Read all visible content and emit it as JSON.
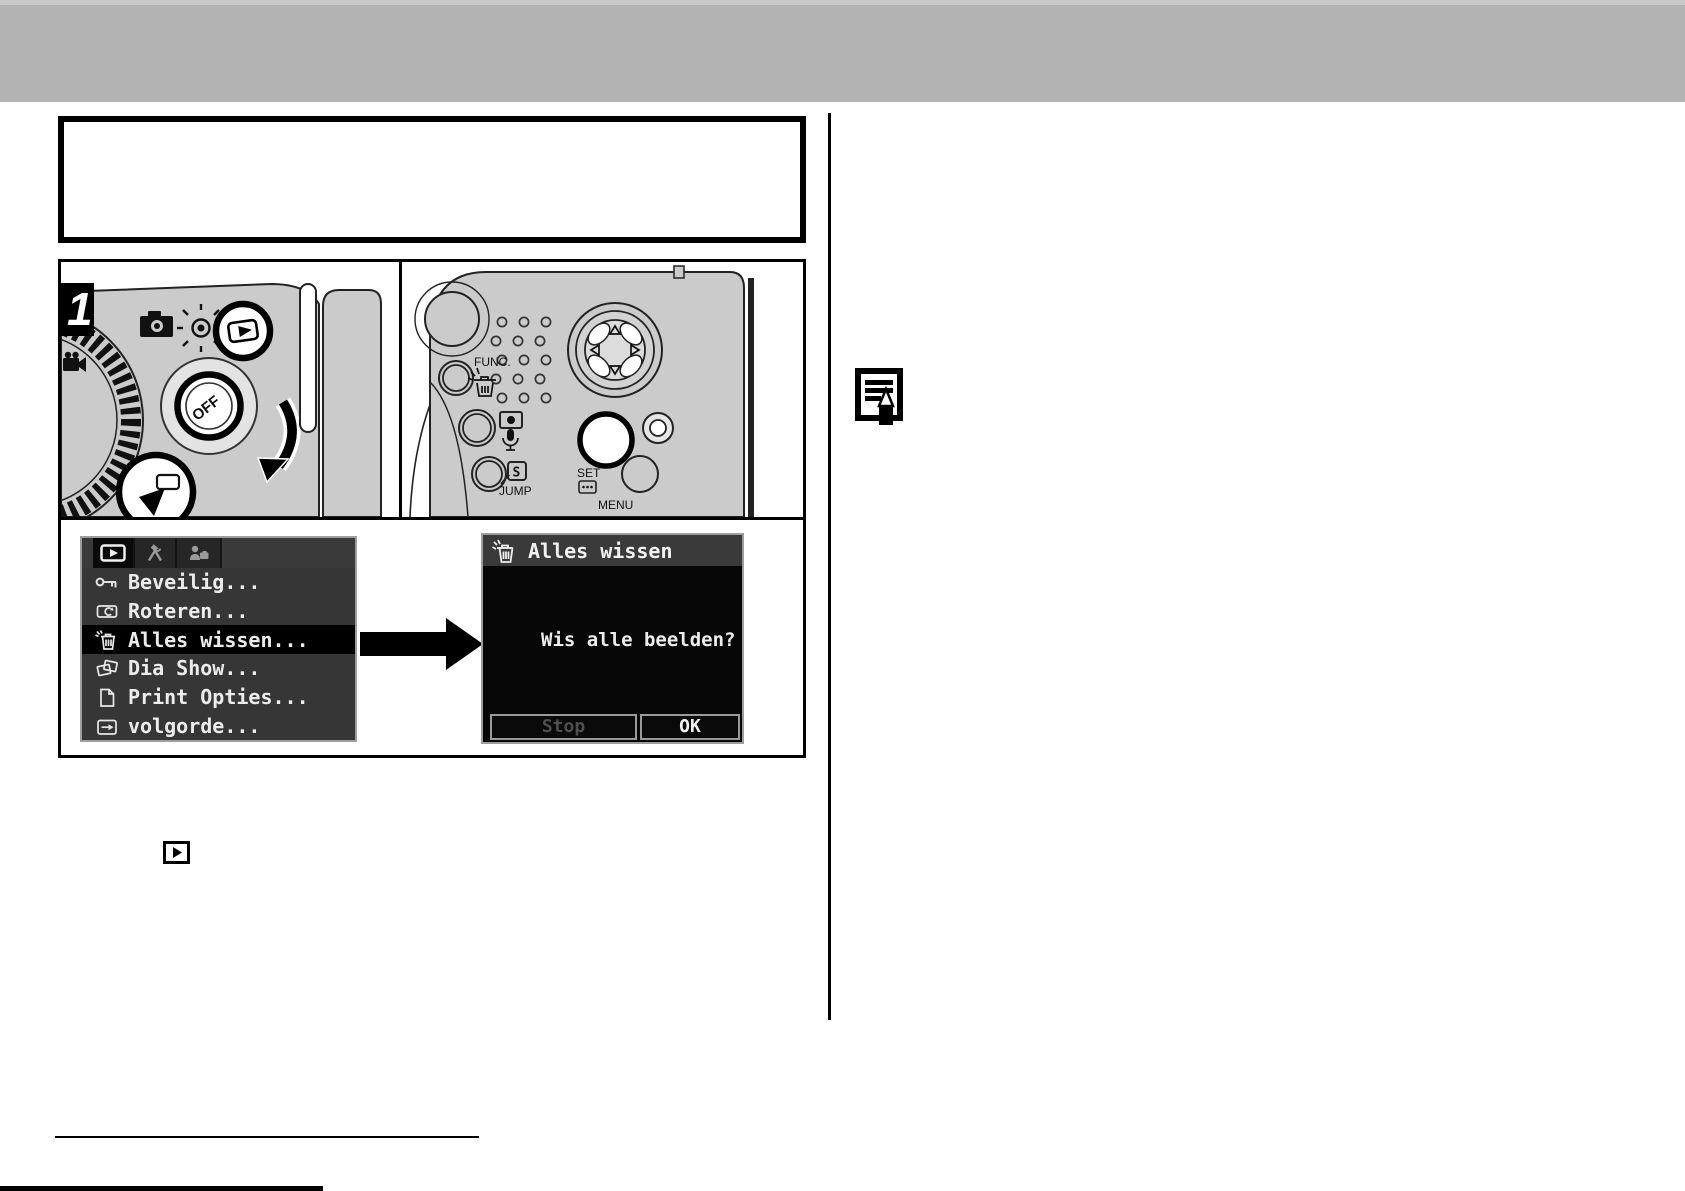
{
  "step": {
    "number": "1"
  },
  "camera": {
    "off": "OFF",
    "func": "FUNC.",
    "jump": "JUMP",
    "jump_s": "S",
    "set": "SET",
    "menu": "MENU"
  },
  "menu_screen": {
    "tabs": [
      {
        "icon": "playback-icon",
        "selected": true
      },
      {
        "icon": "tools-icon",
        "selected": false
      },
      {
        "icon": "my-camera-icon",
        "selected": false
      }
    ],
    "items": [
      {
        "icon": "key-icon",
        "label": "Beveilig...",
        "selected": false
      },
      {
        "icon": "rotate-icon",
        "label": "Roteren...",
        "selected": false
      },
      {
        "icon": "erase-all-icon",
        "label": "Alles wissen...",
        "selected": true
      },
      {
        "icon": "slideshow-icon",
        "label": "Dia Show...",
        "selected": false
      },
      {
        "icon": "print-icon",
        "label": "Print Opties...",
        "selected": false
      },
      {
        "icon": "print-order-icon",
        "label": "volgorde...",
        "selected": false
      }
    ]
  },
  "confirm_screen": {
    "icon": "erase-all-icon",
    "title": "Alles wissen",
    "message": "Wis alle beelden?",
    "buttons": [
      {
        "label": "Stop",
        "enabled": false
      },
      {
        "label": "OK",
        "enabled": true
      }
    ]
  },
  "icons": {
    "note": "memo-pencil-icon",
    "inline": "playback-mode-icon"
  },
  "colors": {
    "header_bar": "#b3b3b3",
    "camera_body": "#cbcbcb",
    "lcd_bg": "#363636",
    "lcd_selected_row": "#000000",
    "lcd_text": "#ececec",
    "disabled_button_text": "#4f4f4f",
    "enabled_button_text": "#f2f2f2"
  }
}
